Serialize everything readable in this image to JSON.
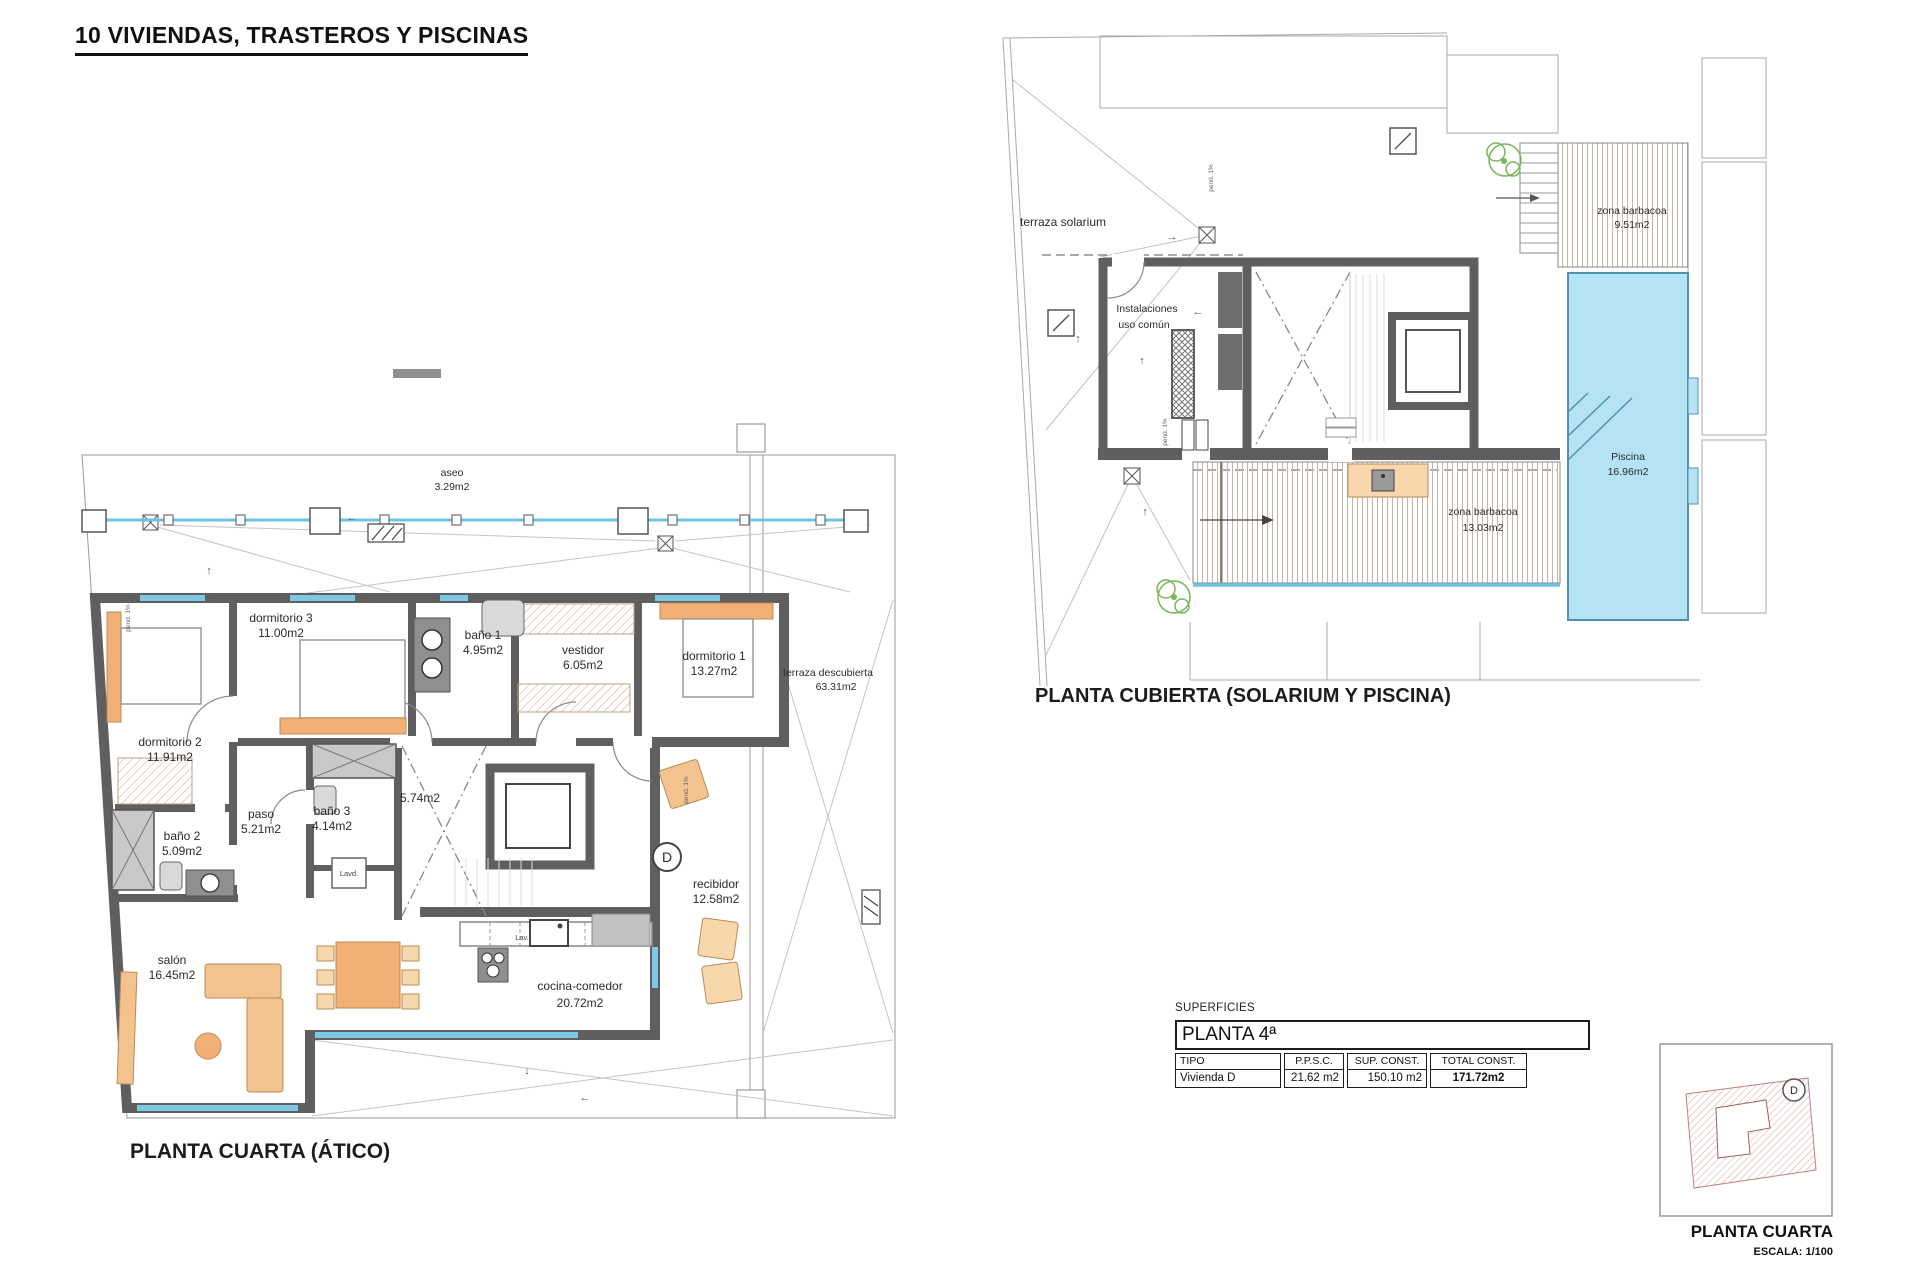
{
  "title": "10 VIVIENDAS, TRASTEROS Y PISCINAS",
  "plan_atico": {
    "caption": "PLANTA CUARTA (ÁTICO)",
    "rooms": {
      "aseo": {
        "name": "aseo",
        "area": "3.29m2"
      },
      "dormitorio3": {
        "name": "dormitorio 3",
        "area": "11.00m2"
      },
      "bano1": {
        "name": "baño 1",
        "area": "4.95m2"
      },
      "vestidor": {
        "name": "vestidor",
        "area": "6.05m2"
      },
      "dormitorio1": {
        "name": "dormitorio 1",
        "area": "13.27m2"
      },
      "terraza": {
        "name": "terraza descubierta",
        "area": "63.31m2"
      },
      "dormitorio2": {
        "name": "dormitorio 2",
        "area": "11.91m2"
      },
      "paso": {
        "name": "paso",
        "area": "5.21m2"
      },
      "bano3": {
        "name": "baño 3",
        "area": "4.14m2"
      },
      "bano2": {
        "name": "baño 2",
        "area": "5.09m2"
      },
      "hueco": {
        "area": "5.74m2"
      },
      "recibidor": {
        "name": "recibidor",
        "area": "12.58m2"
      },
      "cocina": {
        "name": "cocina-comedor",
        "area": "20.72m2"
      },
      "salon": {
        "name": "salón",
        "area": "16.45m2"
      }
    },
    "annotations": {
      "lav": "Lav.",
      "lavd": "Lavd.",
      "unit_letter": "D",
      "pend": "pend. 1%"
    }
  },
  "plan_cubierta": {
    "caption": "PLANTA CUBIERTA (SOLARIUM Y PISCINA)",
    "rooms": {
      "solarium": {
        "name": "terraza solarium"
      },
      "instalaciones": {
        "name_line1": "Instalaciones",
        "name_line2": "uso común"
      },
      "barbacoa_norte": {
        "name": "zona barbacoa",
        "area": "9.51m2"
      },
      "piscina": {
        "name": "Piscina",
        "area": "16.96m2"
      },
      "barbacoa_sur": {
        "name": "zona barbacoa",
        "area": "13.03m2"
      }
    },
    "annotations": {
      "pend": "pend. 1%"
    }
  },
  "surfaces_table": {
    "label": "SUPERFICIES",
    "header": "PLANTA 4ª",
    "columns": [
      "TIPO",
      "P.P.S.C.",
      "SUP. CONST.",
      "TOTAL CONST."
    ],
    "row": [
      "Vivienda D",
      "21.62 m2",
      "150.10 m2",
      "171.72m2"
    ]
  },
  "keyplan": {
    "unit_letter": "D",
    "caption": "PLANTA CUARTA",
    "scale": "ESCALA: 1/100"
  },
  "glyphs": {
    "up_arrow": "↑",
    "down_arrow": "↓",
    "left_arrow": "←",
    "right_arrow": "→"
  },
  "colors": {
    "wall": "#5f5f5f",
    "glass": "#6fc2e0",
    "furniture": "#f2b077",
    "furniture_light": "#f7d7ab",
    "pool_fill": "#b5e3f5",
    "pool_edge": "#4f90ad",
    "deck_line": "#c4b6a6",
    "plant": "#7ab55c",
    "keyplan_hatch": "#dca0a0"
  }
}
